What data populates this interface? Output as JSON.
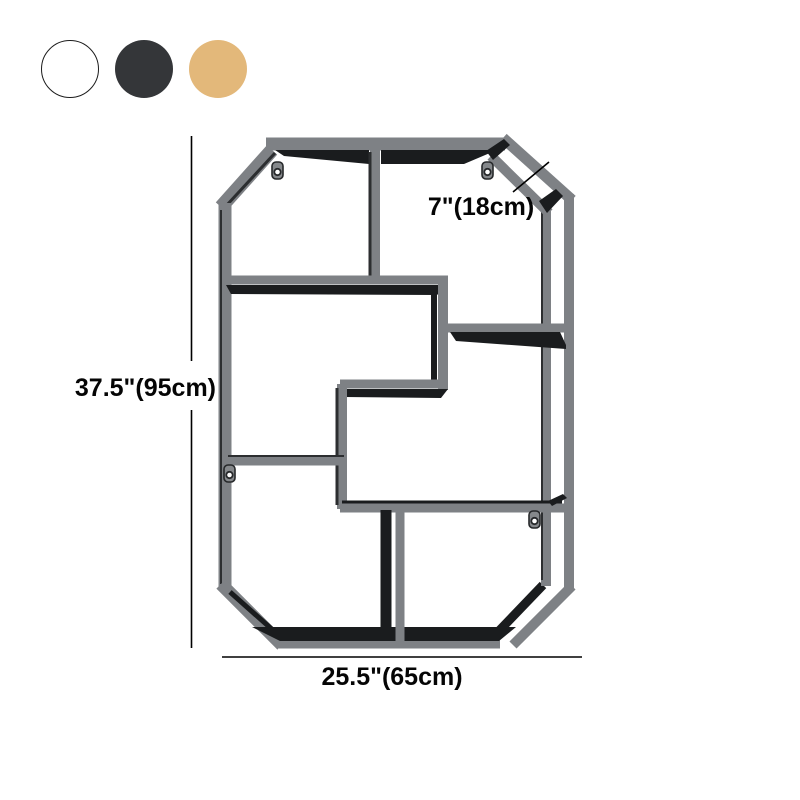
{
  "product": {
    "name": "octagonal-geometric-wall-shelf",
    "color_options": [
      {
        "name": "white",
        "hex": "#ffffff",
        "border": "#1c1c1c"
      },
      {
        "name": "black",
        "hex": "#343639",
        "border": ""
      },
      {
        "name": "gold",
        "hex": "#e3b87a",
        "border": ""
      }
    ]
  },
  "dimensions": {
    "height": "37.5\"(95cm)",
    "width": "25.5\"(65cm)",
    "depth": "7\"(18cm)"
  },
  "artwork": {
    "frame_color": "#7e8185",
    "frame_color_dark": "#6d7074",
    "dark_face_color": "#1a1c1e",
    "dark_edge_color": "#2c2e30",
    "background": "#ffffff",
    "mounting_tab_count": 4
  }
}
